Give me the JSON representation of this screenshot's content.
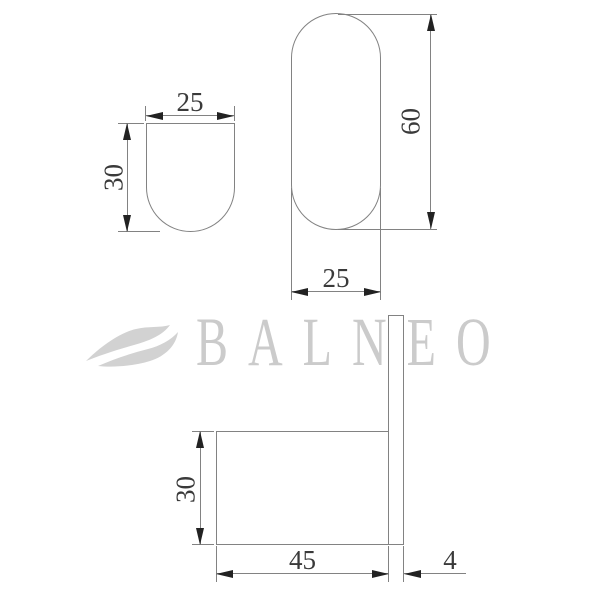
{
  "watermark": {
    "brand": "BALNEO",
    "icon": "wave-icon"
  },
  "views": {
    "small_front": {
      "width_mm": "25",
      "height_mm": "30"
    },
    "large_front": {
      "height_mm": "60",
      "width_mm": "25"
    },
    "side_profile": {
      "depth_mm": "30",
      "length_mm": "45",
      "plate_thickness_mm": "4"
    }
  },
  "colors": {
    "background": "#ffffff",
    "line": "#828282",
    "arrow": "#222222",
    "dimension_text": "#3a3a3a",
    "watermark": "#cbcbcb",
    "watermark_icon": "#d2d2d2"
  }
}
